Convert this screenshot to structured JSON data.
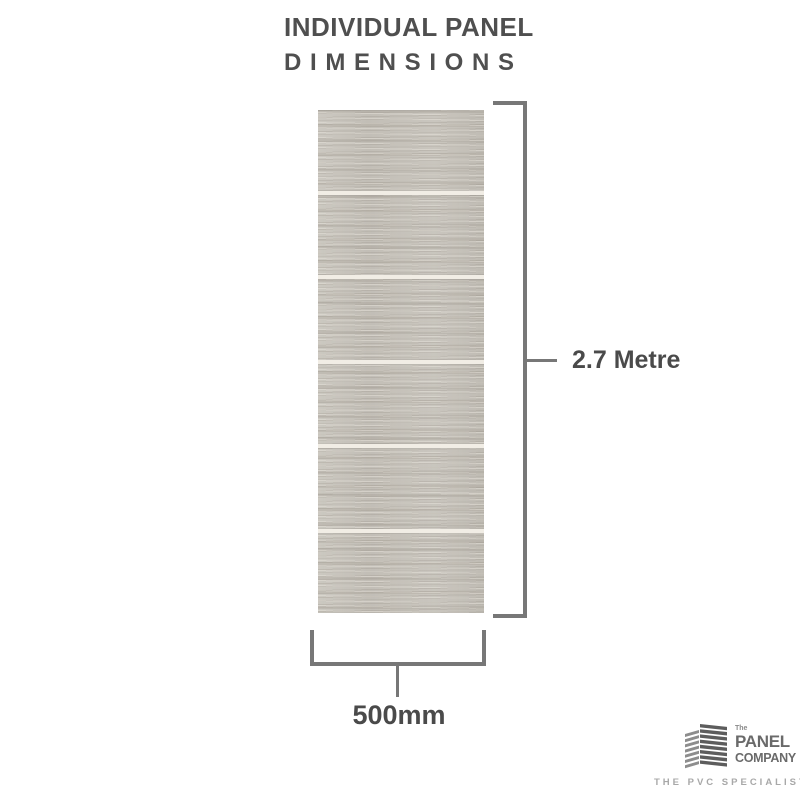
{
  "title": {
    "line1": "INDIVIDUAL PANEL",
    "line2": "D I M E N S I O N S"
  },
  "panel": {
    "section_count": 6,
    "texture_base_color": "#c6c2ba",
    "gap_color": "#f1ede5",
    "material": "light travertine / stone effect PVC panel"
  },
  "dimensions": {
    "height_label": "2.7 Metre",
    "width_label": "500mm",
    "line_color": "#777777"
  },
  "logo": {
    "icon": "stacked-panels-icon",
    "the": "The",
    "brand_line1": "PANEL",
    "brand_line2": "COMPANY",
    "tagline": "THE PVC SPECIALISTS"
  },
  "colors": {
    "heading_text": "#4f4f4f",
    "dimension_text": "#4a4a4a",
    "background": "#ffffff"
  }
}
